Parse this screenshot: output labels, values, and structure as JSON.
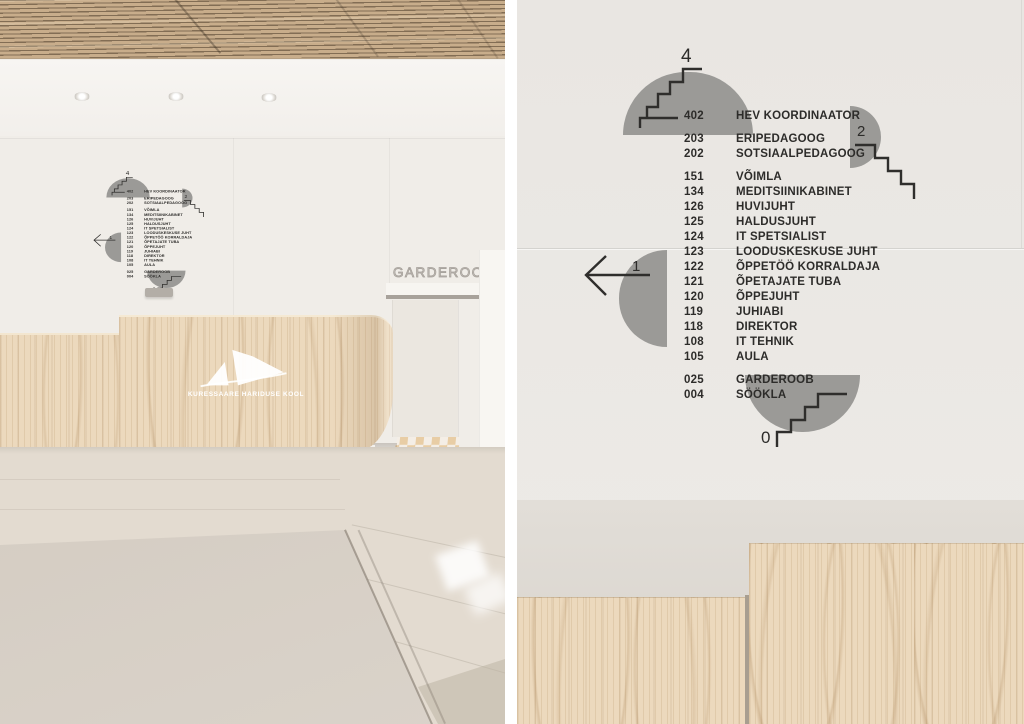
{
  "sign": {
    "floor_top": "4",
    "floor_mid": "2",
    "floor_arrow": "1",
    "floor_bottom": "0",
    "sections": [
      [
        {
          "num": "402",
          "label": "HEV KOORDINAATOR"
        }
      ],
      [
        {
          "num": "203",
          "label": "ERIPEDAGOOG"
        },
        {
          "num": "202",
          "label": "SOTSIAALPEDAGOOG"
        }
      ],
      [
        {
          "num": "151",
          "label": "VÕIMLA"
        },
        {
          "num": "134",
          "label": "MEDITSIINIKABINET"
        },
        {
          "num": "126",
          "label": "HUVIJUHT"
        },
        {
          "num": "125",
          "label": "HALDUSJUHT"
        },
        {
          "num": "124",
          "label": "IT SPETSIALIST"
        },
        {
          "num": "123",
          "label": "LOODUSKESKUSE JUHT"
        },
        {
          "num": "122",
          "label": "ÕPPETÖÖ KORRALDAJA"
        },
        {
          "num": "121",
          "label": "ÕPETAJATE TUBA"
        },
        {
          "num": "120",
          "label": "ÕPPEJUHT"
        },
        {
          "num": "119",
          "label": "JUHIABI"
        },
        {
          "num": "118",
          "label": "DIREKTOR"
        },
        {
          "num": "108",
          "label": "IT TEHNIK"
        },
        {
          "num": "105",
          "label": "AULA"
        }
      ],
      [
        {
          "num": "025",
          "label": "GARDEROOB"
        },
        {
          "num": "004",
          "label": "SÖÖKLA"
        }
      ]
    ]
  },
  "left_photo": {
    "garderoob_sign": "GARDEROOB",
    "desk_logo": "KURESSAARE HARIDUSE KOOL"
  },
  "colors": {
    "sign_gray": "#9b9a97",
    "sign_text": "#2d2c2a",
    "wood": "#ecd9bd",
    "wall_right": "#e9e6e2",
    "wall_left": "#f0ede8"
  }
}
